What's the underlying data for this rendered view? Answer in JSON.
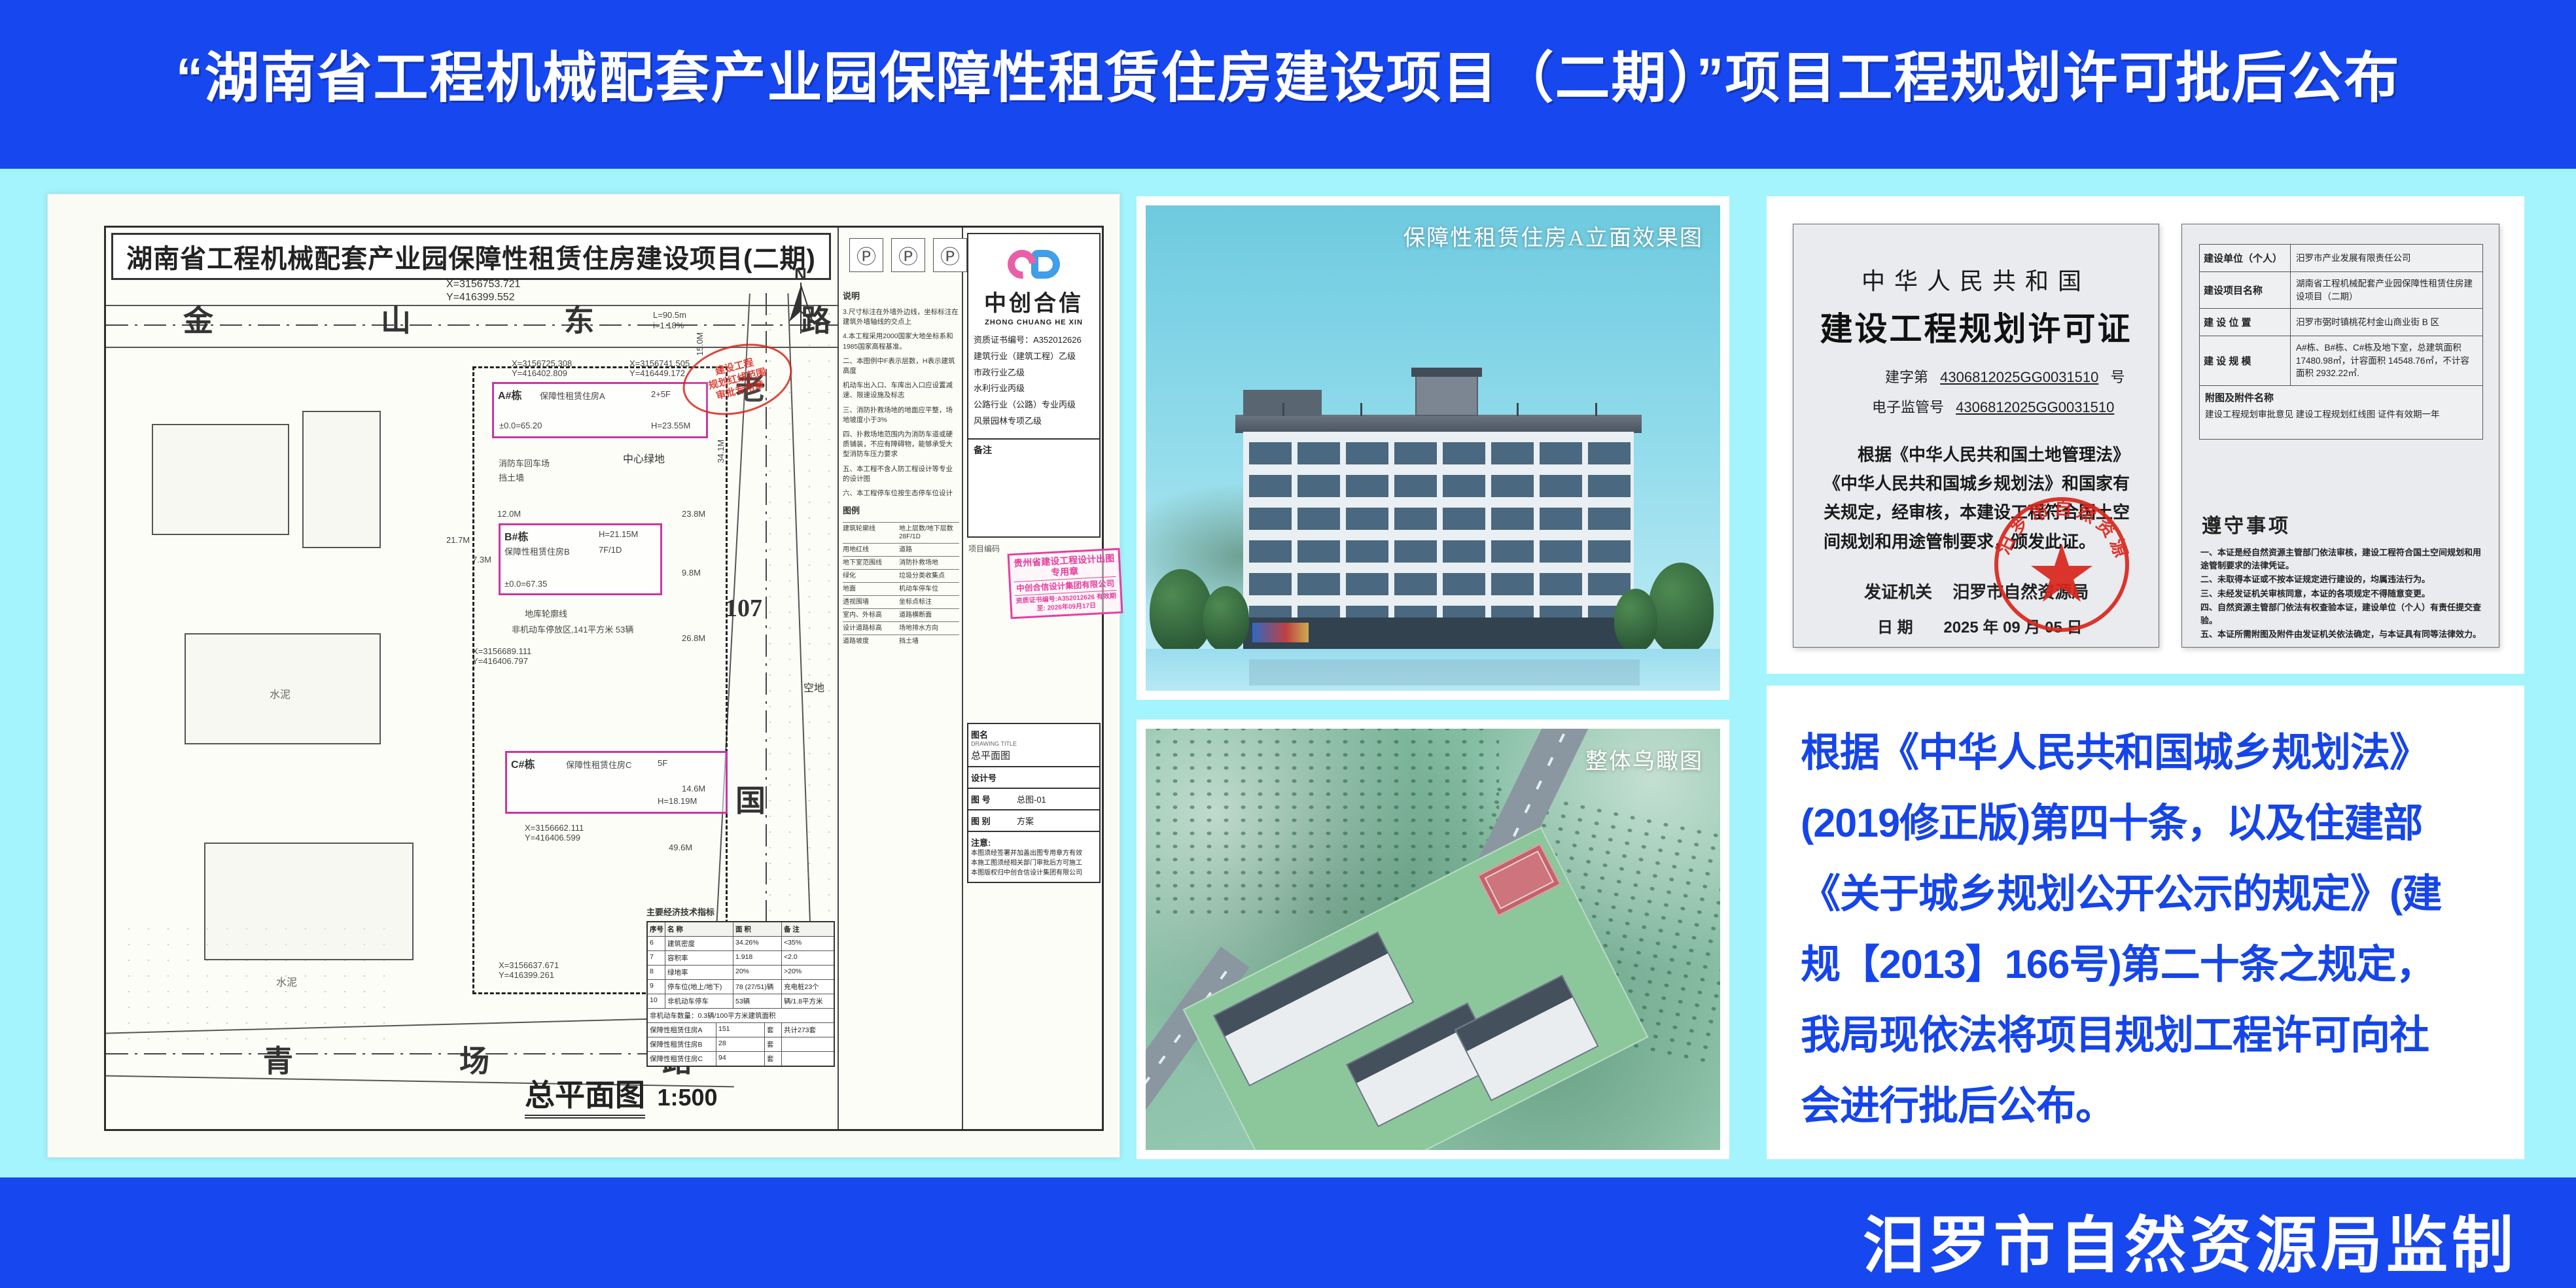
{
  "colors": {
    "bg_blue": "#1747ef",
    "panel_cyan": "#a3f4fd",
    "notice_blue": "#1545ea",
    "seal_red": "#d9261c",
    "stamp_pink": "#e43fa0",
    "new_building_magenta": "#c837a0"
  },
  "header": {
    "title": "“湖南省工程机械配套产业园保障性租赁住房建设项目（二期）”项目工程规划许可批后公布"
  },
  "footer": {
    "credit": "汨罗市自然资源局监制"
  },
  "renders": {
    "elevation_label": "保障性租赁住房A立面效果图",
    "aerial_label": "整体鸟瞰图"
  },
  "site_plan": {
    "sheet_title": "湖南省工程机械配套产业园保障性租赁住房建设项目(二期)",
    "p_mark": "Ⓟ",
    "north": "N",
    "drawing_label": "总平面图",
    "drawing_scale": "1:500",
    "roads": {
      "top": [
        "金",
        "山",
        "东",
        "路"
      ],
      "right": [
        "老",
        "107",
        "国",
        "道"
      ],
      "bottom": [
        "青",
        "场",
        "路"
      ]
    },
    "coords": {
      "c1x": "X=3156753.721",
      "c1y": "Y=416399.552",
      "c2x": "X=3156725.308",
      "c2y": "Y=416402.809",
      "c3x": "X=3156741.505",
      "c3y": "Y=416449.172",
      "c4x": "X=3156689.111",
      "c4y": "Y=416406.797",
      "c5x": "X=3156662.111",
      "c5y": "Y=416406.599",
      "c6x": "X=3156637.671",
      "c6y": "Y=416399.261"
    },
    "dims": {
      "d1": "L=90.5m",
      "d2": "i=1.18%",
      "d3": "15.0M",
      "d4": "34.1M",
      "d5": "12.0M",
      "d6": "23.8M",
      "d7": "26.8M",
      "d8": "9.8M",
      "d9": "49.6M",
      "d10": "14.6M",
      "d11": "21.7M",
      "d12": "7.3M"
    },
    "labels": {
      "green": "中心绿地",
      "fire": "消防车回车场",
      "retain": "挡土墙",
      "garage": "地库轮廓线",
      "parking": "非机动车停放区,141平方米 53辆",
      "vacant": "空地",
      "cement": "水泥",
      "datum": "±0.0=65.20"
    },
    "buildings": {
      "a": {
        "tag": "A#栋",
        "use": "保障性租赁住房A",
        "fh": "2+5F",
        "h": "H=23.55M"
      },
      "b": {
        "tag": "B#栋",
        "use": "保障性租赁住房B",
        "fh": "7F/1D",
        "h": "H=21.15M",
        "elev": "±0.0=67.35"
      },
      "c": {
        "tag": "C#栋",
        "use": "保障性租赁住房C",
        "fh": "5F",
        "h": "H=18.19M"
      }
    },
    "red_seal": {
      "l1": "建设工程",
      "l2": "规划红线范围",
      "l3": "审批专用章"
    },
    "pink_stamp": {
      "l1": "贵州省建设工程设计出图专用章",
      "l2": "中创合信设计集团有限公司",
      "l3": "资质证书编号:A352012626 有效期至: 2026年09月17日"
    },
    "notes_title": "说明",
    "notes": [
      "3.尺寸标注在外墙外边线，坐标标注在建筑外墙轴线的交点上",
      "4.本工程采用2000国家大地坐标系和1985国家高程基准。",
      "二、本图例中F表示层数，H表示建筑高度",
      "机动车出入口、车库出入口应设置减速、限速设施及标志",
      "三、消防扑救场地的地面应平整，场地坡度小于3%",
      "四、扑救场地范围内为消防车道或硬质铺装，不应有障碍物，能够承受大型消防车压力要求",
      "五、本工程不含人防工程设计等专业的设计图",
      "六、本工程停车位按生态停车位设计"
    ],
    "legend_title": "图例",
    "legend": [
      [
        "建筑轮廓线",
        "地上层数/地下层数 28F/1D"
      ],
      [
        "用地红线",
        "道路"
      ],
      [
        "地下室范围线",
        "消防扑救场地"
      ],
      [
        "绿化",
        "垃圾分类收集点"
      ],
      [
        "地面",
        "机动车停车位"
      ],
      [
        "透视围墙",
        "坐标点标注"
      ],
      [
        "室内、外标高",
        "道路横断面"
      ],
      [
        "设计道路标高",
        "场地排水方向"
      ],
      [
        "道路坡度",
        "挡土墙"
      ]
    ],
    "tech_title": "主要经济技术指标",
    "tech_header": [
      "序号",
      "名 称",
      "面 积",
      "备 注"
    ],
    "tech_rows": [
      [
        "6",
        "建筑密度",
        "34.26%",
        "<35%"
      ],
      [
        "7",
        "容积率",
        "1.918",
        "<2.0"
      ],
      [
        "8",
        "绿地率",
        "20%",
        ">20%"
      ],
      [
        "9",
        "停车位(地上/地下)",
        "78 (27/51)辆",
        "充电桩23个"
      ],
      [
        "10",
        "非机动车停车",
        "53辆",
        "辆/1.8平方米"
      ]
    ],
    "tech_note": "非机动车数量：0.3辆/100平方米建筑面积",
    "housing_rows": [
      [
        "保障性租赁住房A",
        "151",
        "套"
      ],
      [
        "保障性租赁住房B",
        "28",
        "套"
      ],
      [
        "保障性租赁住房C",
        "94",
        "套"
      ]
    ],
    "housing_total": "共计273套",
    "firm": {
      "name": "中创合信",
      "name_en": "ZHONG CHUANG HE XIN",
      "cert": "资质证书编号：A352012626",
      "quals": [
        "建筑行业（建筑工程）乙级",
        "市政行业乙级",
        "水利行业丙级",
        "公路行业（公路）专业丙级",
        "风景园林专项乙级"
      ],
      "remark": "备注",
      "project_code": "项目编码"
    },
    "title_block": {
      "tu_ming": "图名",
      "tu_ming_en": "DRAWING TITLE",
      "tu_ming_val": "总平面图",
      "she_ji_hao": "设计号",
      "tu_hao": "图 号",
      "tu_hao_val": "总图-01",
      "tu_bie": "图 别",
      "tu_bie_val": "方案",
      "notice_label": "注意:",
      "notices": [
        "本图须经签署并加盖出图专用章方有效",
        "本施工图须经相关部门审批后方可施工",
        "本图版权归中创合信设计集团有限公司"
      ]
    }
  },
  "certificate": {
    "country": "中华人民共和国",
    "title": "建设工程规划许可证",
    "no_prefix": "建字第",
    "no_value": "4306812025GG0031510",
    "no_suffix": "号",
    "ereg_label": "电子监管号",
    "ereg_value": "4306812025GG0031510",
    "body": "根据《中华人民共和国土地管理法》《中华人民共和国城乡规划法》和国家有关规定，经审核，本建设工程符合国土空间规划和用途管制要求，颁发此证。",
    "issuer_label": "发证机关",
    "issuer": "汨罗市自然资源局",
    "date_label": "日 期",
    "date": "2025 年 09 月 05 日",
    "seal_text": "汨罗市自然资源局",
    "fields": [
      {
        "k": "建设单位（个人）",
        "v": "汨罗市产业发展有限责任公司"
      },
      {
        "k": "建设项目名称",
        "v": "湖南省工程机械配套产业园保障性租赁住房建设项目（二期）"
      },
      {
        "k": "建 设 位 置",
        "v": "汨罗市弼时镇桃花村金山商业街 B 区"
      },
      {
        "k": "建 设 规 模",
        "v": "A#栋、B#栋、C#栋及地下室，总建筑面积 17480.98㎡，计容面积 14548.76㎡，不计容面积 2932.22㎡."
      }
    ],
    "attach_label": "附图及附件名称",
    "attach_value": "建设工程规划审批意见  建设工程规划红线图  证件有效期一年",
    "rules_title": "遵守事项",
    "rules": [
      "一、本证是经自然资源主管部门依法审核，建设工程符合国土空间规划和用途管制要求的法律凭证。",
      "二、未取得本证或不按本证规定进行建设的，均属违法行为。",
      "三、未经发证机关审核同意，本证的各项规定不得随意变更。",
      "四、自然资源主管部门依法有权查验本证，建设单位（个人）有责任提交查验。",
      "五、本证所需附图及附件由发证机关依法确定，与本证具有同等法律效力。"
    ]
  },
  "notice": {
    "lines": [
      "根据《中华人民共和国城乡规划法》",
      "(2019修正版)第四十条，以及住建部",
      "《关于城乡规划公开公示的规定》(建",
      "规【2013】166号)第二十条之规定，",
      "我局现依法将项目规划工程许可向社",
      "会进行批后公布。"
    ]
  }
}
